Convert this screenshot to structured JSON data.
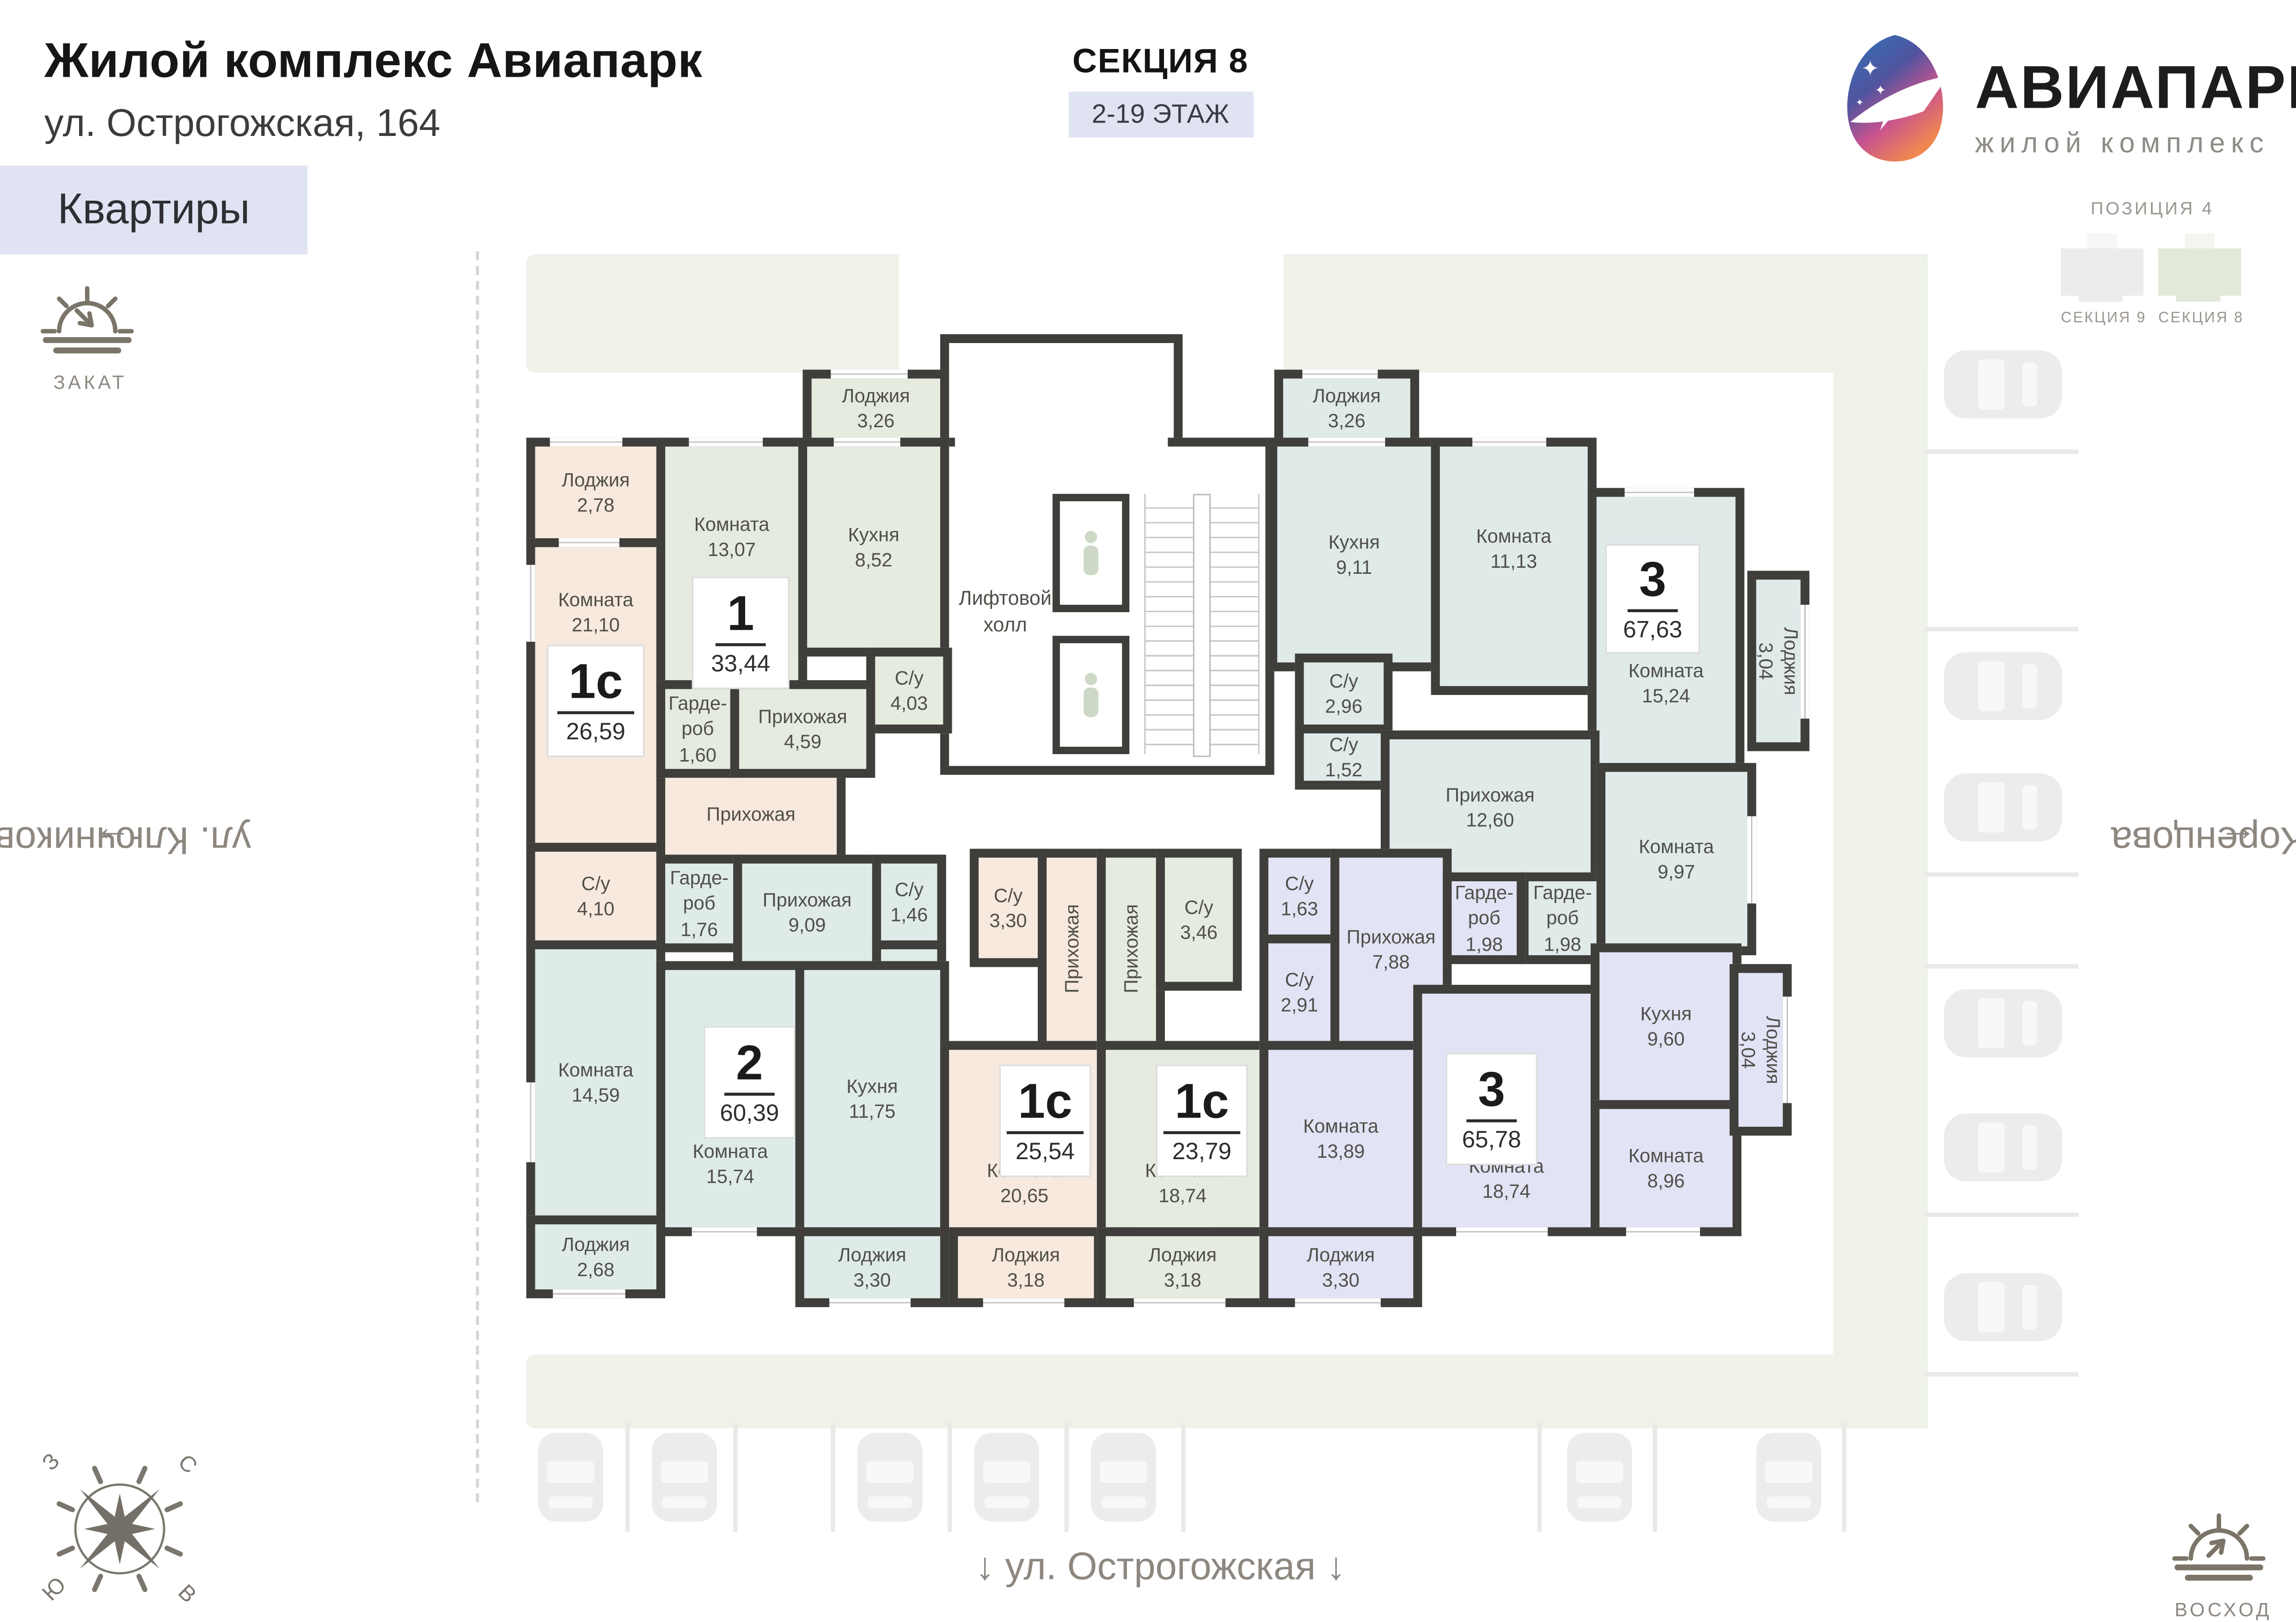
{
  "header": {
    "title": "Жилой комплекс Авиапарк",
    "address": "ул. Острогожская, 164"
  },
  "section": {
    "name": "СЕКЦИЯ 8",
    "floors": "2-19 ЭТАЖ"
  },
  "logo": {
    "name": "АВИАПАРК",
    "subtitle": "жилой комплекс"
  },
  "nav": {
    "apartments_tab": "Квартиры"
  },
  "sun": {
    "sunset": "ЗАКАТ",
    "sunrise": "ВОСХОД"
  },
  "position": {
    "title": "ПОЗИЦИЯ 4",
    "sections": [
      "СЕКЦИЯ 9",
      "СЕКЦИЯ 8"
    ]
  },
  "streets": {
    "left": "ул. Ключникова",
    "right": "ул. Коренцова",
    "bottom": "ул. Острогожская"
  },
  "street_arrows": {
    "up": "→",
    "up_right_side": "←",
    "down": "↓"
  },
  "compass": {
    "north": "С",
    "east": "В",
    "south": "Ю",
    "west": "З"
  },
  "core": {
    "label": "Лифтовой\nхолл"
  },
  "apartments": [
    {
      "type": "1с",
      "area": "26,59",
      "color": "peach",
      "rooms": [
        {
          "name": "Лоджия",
          "area": "2,78"
        },
        {
          "name": "Комната",
          "area": "21,10"
        },
        {
          "name": "С/у",
          "area": "4,10"
        },
        {
          "name": "Прихожая",
          "area": ""
        }
      ]
    },
    {
      "type": "1",
      "area": "33,44",
      "color": "green",
      "rooms": [
        {
          "name": "Лоджия",
          "area": "3,26"
        },
        {
          "name": "Комната",
          "area": "13,07"
        },
        {
          "name": "Кухня",
          "area": "8,52"
        },
        {
          "name": "С/у",
          "area": "4,03"
        },
        {
          "name": "Гарде-\nроб",
          "area": "1,60"
        },
        {
          "name": "Прихожая",
          "area": "4,59"
        }
      ]
    },
    {
      "type": "3",
      "area": "67,63",
      "color": "blue",
      "rooms": [
        {
          "name": "Лоджия",
          "area": "3,26"
        },
        {
          "name": "Кухня",
          "area": "9,11"
        },
        {
          "name": "Комната",
          "area": "11,13"
        },
        {
          "name": "Комната",
          "area": "15,24"
        },
        {
          "name": "С/у",
          "area": "2,96"
        },
        {
          "name": "С/у",
          "area": "1,52"
        },
        {
          "name": "Прихожая",
          "area": "12,60"
        },
        {
          "name": "Гарде-\nроб",
          "area": "1,98"
        },
        {
          "name": "Комната",
          "area": "9,97"
        },
        {
          "name": "Лоджия",
          "area": "3,04"
        }
      ]
    },
    {
      "type": "2",
      "area": "60,39",
      "color": "teal",
      "rooms": [
        {
          "name": "Комната",
          "area": "14,59"
        },
        {
          "name": "Лоджия",
          "area": "2,68"
        },
        {
          "name": "Гарде-\nроб",
          "area": "1,76"
        },
        {
          "name": "Прихожая",
          "area": "9,09"
        },
        {
          "name": "С/у",
          "area": "1,46"
        },
        {
          "name": "С/у",
          "area": "3,01"
        },
        {
          "name": "Комната",
          "area": "15,74"
        },
        {
          "name": "Кухня",
          "area": "11,75"
        },
        {
          "name": "Лоджия",
          "area": "3,30"
        }
      ]
    },
    {
      "type": "1с",
      "area": "25,54",
      "color": "peach",
      "rooms": [
        {
          "name": "С/у",
          "area": "3,30"
        },
        {
          "name": "Прихожая",
          "area": ""
        },
        {
          "name": "Комната",
          "area": "20,65"
        },
        {
          "name": "Лоджия",
          "area": "3,18"
        }
      ]
    },
    {
      "type": "1с",
      "area": "23,79",
      "color": "green",
      "rooms": [
        {
          "name": "Прихожая",
          "area": ""
        },
        {
          "name": "С/у",
          "area": "3,46"
        },
        {
          "name": "Комната",
          "area": "18,74"
        },
        {
          "name": "Лоджия",
          "area": "3,18"
        }
      ]
    },
    {
      "type": "3",
      "area": "65,78",
      "color": "lavender",
      "rooms": [
        {
          "name": "С/у",
          "area": "1,63"
        },
        {
          "name": "С/у",
          "area": "2,91"
        },
        {
          "name": "Прихожая",
          "area": "7,88"
        },
        {
          "name": "Гарде-\nроб",
          "area": "1,98"
        },
        {
          "name": "Комната",
          "area": "13,89"
        },
        {
          "name": "Комната",
          "area": "18,74"
        },
        {
          "name": "Кухня",
          "area": "9,60"
        },
        {
          "name": "Комната",
          "area": "8,96"
        },
        {
          "name": "Лоджия",
          "area": "3,30"
        },
        {
          "name": "Лоджия",
          "area": "3,04"
        }
      ]
    }
  ],
  "colors": {
    "peach": "#f7e9dd",
    "green": "#e5ebdf",
    "blue": "#dfeae9",
    "teal": "#dfebe8",
    "lavender": "#e2e4f5",
    "wall": "#3f3e3b",
    "plot": "#eef2e9",
    "accent": "#dfe3f2"
  },
  "icons": {
    "sunset": "sunset-icon",
    "sunrise": "sunrise-icon",
    "compass": "compass-rose-icon",
    "parking": "car-icon",
    "elevator": "elevator-person-icon",
    "logo": "airplane-logo-icon"
  }
}
